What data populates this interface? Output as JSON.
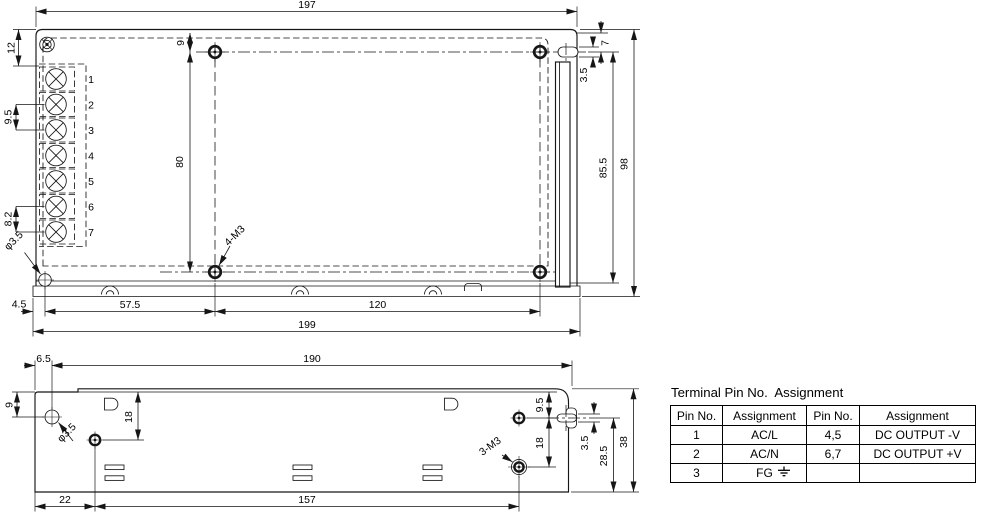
{
  "top_view": {
    "dims": {
      "width_case": "197",
      "width_base": "199",
      "hole_offset_x": "57.5",
      "hole_span_x": "120",
      "base_offset": "4.5",
      "corner_inset": "12",
      "pin_pitch_ac": "9.5",
      "pin_pitch_dc": "8.2",
      "hole_offset_top": "9",
      "hole_span_y": "80",
      "slot_offset": "7",
      "slot_width": "3.5",
      "height_inner": "85.5",
      "height_case": "98",
      "mounting_holes_label": "4-M3",
      "corner_hole_dia": "φ3.5"
    },
    "pin_labels": [
      "1",
      "2",
      "3",
      "4",
      "5",
      "6",
      "7"
    ]
  },
  "side_view": {
    "dims": {
      "width": "190",
      "hole_offset_left": "6.5",
      "hole_offset_top": "9",
      "hole_drop_left": "18",
      "hole_offset_x": "22",
      "hole_span_x": "157",
      "slot_offset_top": "9.5",
      "hole_drop_right": "18",
      "slot_width": "3.5",
      "slot_to_bottom": "28.5",
      "height": "38",
      "mounting_holes_label": "3-M3",
      "corner_hole_dia": "φ3.5"
    }
  },
  "pin_table": {
    "title": "Terminal Pin No.  Assignment",
    "headers": [
      "Pin No.",
      "Assignment",
      "Pin No.",
      "Assignment"
    ],
    "rows": [
      [
        "1",
        "AC/L",
        "4,5",
        "DC OUTPUT -V"
      ],
      [
        "2",
        "AC/N",
        "6,7",
        "DC OUTPUT +V"
      ],
      [
        "3",
        "FG",
        "",
        ""
      ]
    ]
  }
}
